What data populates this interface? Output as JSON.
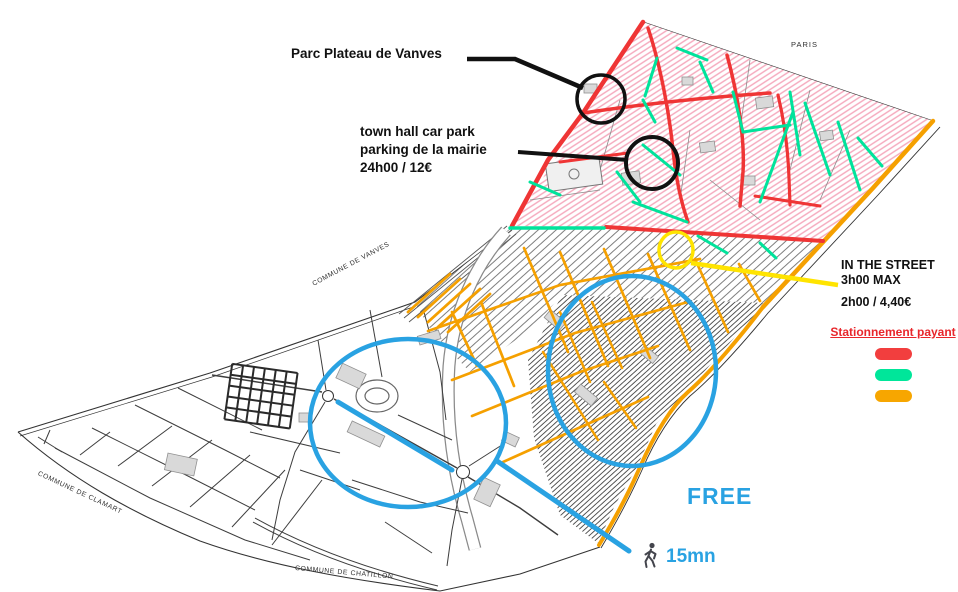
{
  "colors": {
    "paid_red": "#EF3535",
    "paid_green": "#00E39B",
    "paid_orange": "#F5A000",
    "free_blue": "#29A2E2",
    "highlight_yellow": "#FFE400",
    "annotation_black": "#111111",
    "pink_hatch": "#F5A8BC",
    "legend_title_red": "#E8262B"
  },
  "annotations": {
    "parc": {
      "label": "Parc Plateau de Vanves"
    },
    "town_hall": {
      "line1": "town hall car park",
      "line2": "parking de la mairie",
      "line3": "24h00 / 12€"
    },
    "in_the_street": {
      "line1": "IN THE STREET",
      "line2": "3h00 MAX",
      "line3": "2h00 / 4,40€"
    },
    "free": {
      "label": "FREE"
    },
    "walk_time": {
      "label": "15mn",
      "icon": "walking-person"
    }
  },
  "legend": {
    "title": "Stationnement payant",
    "items": [
      {
        "name": "paid-street-red",
        "color": "#F23E3E"
      },
      {
        "name": "paid-street-green",
        "color": "#00E69A"
      },
      {
        "name": "paid-street-orange",
        "color": "#F7A600"
      }
    ]
  },
  "map_labels": {
    "paris": "PARIS",
    "commune_vanves": "COMMUNE DE VANVES",
    "commune_clamart": "COMMUNE DE CLAMART",
    "commune_chatillon": "COMMUNE DE CHATILLON"
  }
}
